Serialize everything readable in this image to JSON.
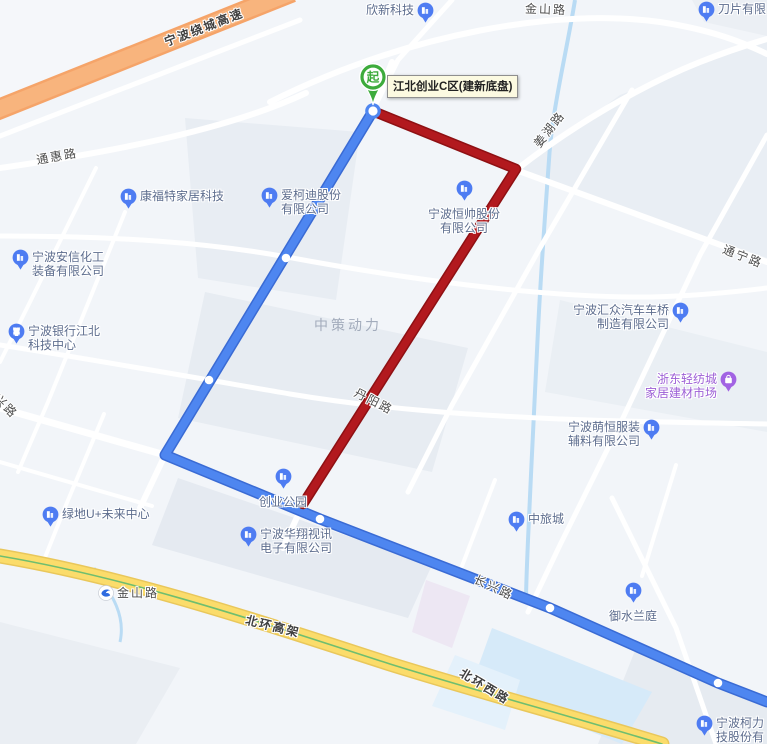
{
  "map": {
    "colors": {
      "route_blue": "#4E86F0",
      "route_blue_casing": "#3A6BD4",
      "route_red": "#B2191E",
      "route_red_casing": "#8E1013",
      "highway_orange": "#F5A469",
      "highway_yellow": "#FBDC6B",
      "start_green": "#3DAB3C",
      "poi_pin_blue": "#4E7CF2",
      "poi_pin_purple": "#A263E3",
      "poi_text": "#5D6D8E",
      "poi_text_purple": "#9C5FD6",
      "water": "#C9E3F7",
      "tooltip_bg": "#FCFAE1"
    },
    "start_marker": {
      "glyph": "起",
      "label": "江北创业C区(建新底盘)"
    },
    "area_label": {
      "text": "中策动力",
      "x": 348,
      "y": 325
    },
    "road_labels": [
      {
        "id": "raocheng-gaosu",
        "text": "宁波绕城高速",
        "x": 204,
        "y": 27,
        "rotate": -21,
        "bold": true
      },
      {
        "id": "jinshan-lu-top",
        "text": "金山路",
        "x": 546,
        "y": 9,
        "rotate": 2,
        "bold": false
      },
      {
        "id": "tonghui-lu",
        "text": "通惠路",
        "x": 57,
        "y": 156,
        "rotate": -10,
        "bold": false
      },
      {
        "id": "jianghu-lu",
        "text": "姜湖路",
        "x": 549,
        "y": 129,
        "rotate": -52,
        "bold": false
      },
      {
        "id": "tongning-lu",
        "text": "通宁路",
        "x": 743,
        "y": 256,
        "rotate": 21,
        "bold": false
      },
      {
        "id": "danyang-lu",
        "text": "丹阳路",
        "x": 374,
        "y": 401,
        "rotate": 27,
        "bold": false
      },
      {
        "id": "xing-lu",
        "text": "兴路",
        "x": 6,
        "y": 406,
        "rotate": 45,
        "bold": false
      },
      {
        "id": "changxing-lu",
        "text": "长兴路",
        "x": 494,
        "y": 587,
        "rotate": 25,
        "bold": false
      },
      {
        "id": "beihuan-gaojia",
        "text": "北环高架",
        "x": 273,
        "y": 626,
        "rotate": 14,
        "bold": true
      },
      {
        "id": "beihuan-xilu",
        "text": "北环西路",
        "x": 485,
        "y": 686,
        "rotate": 31,
        "bold": true
      }
    ],
    "pois": [
      {
        "id": "xinxin-keji",
        "lines": [
          "欣新科技"
        ],
        "icon": "building",
        "iconPos": "right",
        "x": 366,
        "y": 3
      },
      {
        "id": "daopian-youxian",
        "lines": [
          "刀片有限"
        ],
        "icon": "building",
        "iconPos": "left",
        "x": 698,
        "y": 2
      },
      {
        "id": "kangfute-jiaju",
        "lines": [
          "康福特家居科技"
        ],
        "icon": "building",
        "iconPos": "left",
        "x": 120,
        "y": 189
      },
      {
        "id": "aikedi-gufen",
        "lines": [
          "爱柯迪股份",
          "有限公司"
        ],
        "icon": "building",
        "iconPos": "left",
        "x": 261,
        "y": 188
      },
      {
        "id": "anxin-huagong",
        "lines": [
          "宁波安信化工",
          "装备有限公司"
        ],
        "icon": "building",
        "iconPos": "left",
        "x": 12,
        "y": 250
      },
      {
        "id": "ningbo-bank-jiangbei",
        "lines": [
          "宁波银行江北",
          "科技中心"
        ],
        "icon": "bank",
        "iconPos": "left",
        "x": 8,
        "y": 324
      },
      {
        "id": "hengshuai-gufen",
        "lines": [
          "宁波恒帅股份",
          "有限公司"
        ],
        "icon": "building",
        "iconPos": "top",
        "x": 464,
        "y": 181
      },
      {
        "id": "huizhong-qiche",
        "lines": [
          "宁波汇众汽车车桥",
          "制造有限公司"
        ],
        "icon": "building",
        "iconPos": "right",
        "x": 573,
        "y": 303,
        "alignRight": true
      },
      {
        "id": "zhedong-qingfangcheng",
        "lines": [
          "浙东轻纺城",
          "家居建材市场"
        ],
        "icon": "shop",
        "iconPos": "right",
        "x": 645,
        "y": 372,
        "color": "#9C5FD6",
        "alignRight": true
      },
      {
        "id": "mengheng-fuzhuang",
        "lines": [
          "宁波萌恒服装",
          "辅料有限公司"
        ],
        "icon": "building",
        "iconPos": "right",
        "x": 568,
        "y": 420,
        "alignRight": true
      },
      {
        "id": "lvdi-u-center",
        "lines": [
          "绿地U+未来中心"
        ],
        "icon": "building",
        "iconPos": "left",
        "x": 42,
        "y": 507
      },
      {
        "id": "chuangye-park",
        "lines": [
          "创业公园"
        ],
        "icon": "building",
        "iconPos": "top",
        "x": 283,
        "y": 469
      },
      {
        "id": "huaxiang-shixun",
        "lines": [
          "宁波华翔视讯",
          "电子有限公司"
        ],
        "icon": "building",
        "iconPos": "left",
        "x": 240,
        "y": 527
      },
      {
        "id": "zhonglvcheng",
        "lines": [
          "中旅城"
        ],
        "icon": "building",
        "iconPos": "left",
        "x": 508,
        "y": 512
      },
      {
        "id": "yushui-lanting",
        "lines": [
          "御水兰庭"
        ],
        "icon": "building",
        "iconPos": "top",
        "x": 633,
        "y": 583
      },
      {
        "id": "ningbo-keli",
        "lines": [
          "宁波柯力",
          "技股份有"
        ],
        "icon": "building",
        "iconPos": "left",
        "x": 696,
        "y": 716
      },
      {
        "id": "jinshan-lu-metro",
        "lines": [
          "金山路"
        ],
        "icon": "metro",
        "iconPos": "left",
        "x": 98,
        "y": 586,
        "color": "#4c4c4c",
        "roadStyle": true
      }
    ]
  }
}
